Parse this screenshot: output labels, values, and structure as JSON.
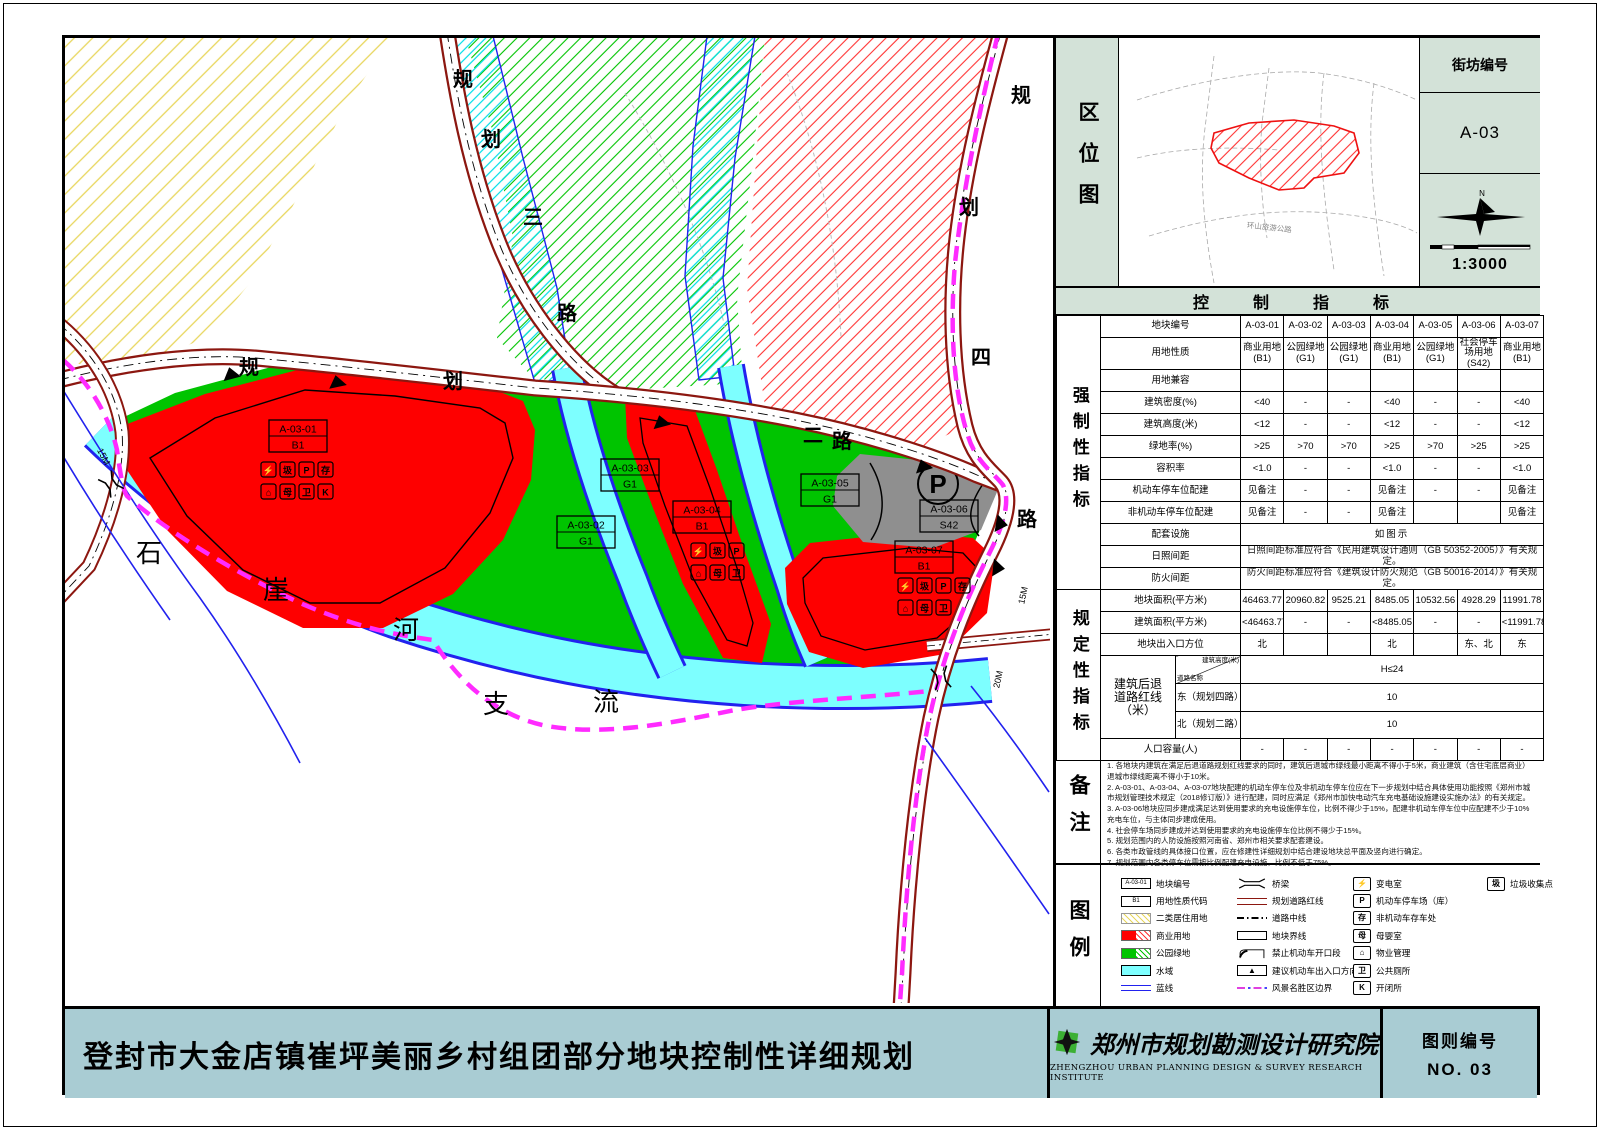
{
  "sheet": {
    "title": "登封市大金店镇崔坪美丽乡村组团部分地块控制性详细规划",
    "institute_name": "郑州市规划勘测设计研究院",
    "institute_name_en": "ZHENGZHOU URBAN PLANNING DESIGN & SURVEY RESEARCH INSTITUTE",
    "sheet_no_label": "图则编号",
    "sheet_no_value": "NO. 03"
  },
  "location_map": {
    "panel_title": "区位图",
    "block_label": "街坊编号",
    "block_value": "A-03",
    "scale_text": "1:3000",
    "north_label": "N",
    "road_label": "环山旅游公路"
  },
  "control_table": {
    "title": "控　制　指　标",
    "mandatory_label": "强制性指标",
    "prescriptive_label": "规定性指标",
    "plot_row_label": "地块编号",
    "plots": [
      "A-03-01",
      "A-03-02",
      "A-03-03",
      "A-03-04",
      "A-03-05",
      "A-03-06",
      "A-03-07"
    ],
    "rows": [
      {
        "label": "用地性质",
        "values": [
          "商业用地\n(B1)",
          "公园绿地\n(G1)",
          "公园绿地\n(G1)",
          "商业用地\n(B1)",
          "公园绿地\n(G1)",
          "社会停车\n场用地(S42)",
          "商业用地\n(B1)"
        ]
      },
      {
        "label": "用地兼容",
        "values": [
          "",
          "",
          "",
          "",
          "",
          "",
          ""
        ]
      },
      {
        "label": "建筑密度(%)",
        "values": [
          "<40",
          "-",
          "-",
          "<40",
          "-",
          "-",
          "<40"
        ]
      },
      {
        "label": "建筑高度(米)",
        "values": [
          "<12",
          "-",
          "-",
          "<12",
          "-",
          "-",
          "<12"
        ]
      },
      {
        "label": "绿地率(%)",
        "values": [
          ">25",
          ">70",
          ">70",
          ">25",
          ">70",
          ">25",
          ">25"
        ]
      },
      {
        "label": "容积率",
        "values": [
          "<1.0",
          "-",
          "-",
          "<1.0",
          "-",
          "-",
          "<1.0"
        ]
      },
      {
        "label": "机动车停车位配建",
        "values": [
          "见备注",
          "-",
          "-",
          "见备注",
          "-",
          "-",
          "见备注"
        ]
      },
      {
        "label": "非机动车停车位配建",
        "values": [
          "见备注",
          "-",
          "-",
          "见备注",
          "",
          "",
          "见备注"
        ]
      }
    ],
    "span_rows": [
      {
        "label": "配套设施",
        "value": "如图示",
        "big": true
      },
      {
        "label": "日照间距",
        "value": "日照间距标准应符合《民用建筑设计通则（GB 50352-2005）》有关规定。",
        "big": false
      },
      {
        "label": "防火间距",
        "value": "防火间距标准应符合《建筑设计防火规范（GB 50016-2014）》有关规定。",
        "big": false
      }
    ],
    "prescriptive_rows": [
      {
        "label": "地块面积(平方米)",
        "values": [
          "46463.77",
          "20960.82",
          "9525.21",
          "8485.05",
          "10532.56",
          "4928.29",
          "11991.78"
        ]
      },
      {
        "label": "建筑面积(平方米)",
        "values": [
          "<46463.77",
          "-",
          "-",
          "<8485.05",
          "-",
          "-",
          "<11991.78"
        ]
      },
      {
        "label": "地块出入口方位",
        "values": [
          "北",
          "",
          "",
          "北",
          "",
          "东、北",
          "东"
        ]
      }
    ],
    "setback": {
      "label": "建筑后退\n道路红线\n（米）",
      "diag_top": "建筑高度(米)",
      "diag_bottom": "道路名称",
      "height_value": "H≤24",
      "roads": [
        {
          "name": "东（规划四路）",
          "value": "10"
        },
        {
          "name": "北（规划二路）",
          "value": "10"
        }
      ]
    },
    "capacity_row": {
      "label": "人口容量(人)",
      "values": [
        "-",
        "-",
        "-",
        "-",
        "-",
        "-",
        "-"
      ]
    }
  },
  "notes": {
    "label": "备注",
    "lines": [
      "1. 各地块内建筑在满足后退道路规划红线要求的同时，建筑后退城市绿线最小距离不得小于5米，商业建筑（含住宅底层商业）退城市绿线距离不得小于10米。",
      "2. A-03-01、A-03-04、A-03-07地块配建的机动车停车位及非机动车停车位应在下一步规划中结合具体使用功能按照《郑州市城市规划管理技术规定（2018修订版）》进行配建，同时应满足《郑州市加快电动汽车充电基础设施建设实施办法》的有关规定。",
      "3. A-03-06地块应同步建成满足达到使用要求的充电设施停车位，比例不得少于15%，配建非机动车停车位中应配建不少于10%充电车位，与主体同步建成使用。",
      "4. 社会停车场同步建成并达到使用要求的充电设施停车位比例不得少于15%。",
      "5. 规划范围内的人防设施按照河南省、郑州市相关要求配套建设。",
      "6. 各类市政管线的具体接口位置，应在修建性详细规划中结合建设地块总平面及竖向进行确定。",
      "7. 规划范围内各类停车位需按比例配建充电设施，比例不低于75%。"
    ]
  },
  "legend": {
    "label": "图例",
    "col1": [
      {
        "type": "codebox",
        "text": "A-03-01",
        "label": "地块编号"
      },
      {
        "type": "codebox",
        "text": "B1",
        "label": "用地性质代码"
      },
      {
        "type": "hatchY",
        "label": "二类居住用地"
      },
      {
        "type": "red",
        "label": "商业用地"
      },
      {
        "type": "green",
        "label": "公园绿地"
      },
      {
        "type": "cyan",
        "label": "水域"
      },
      {
        "type": "blueline",
        "label": "蓝线"
      }
    ],
    "col2": [
      {
        "type": "bridge",
        "label": "桥梁"
      },
      {
        "type": "redline",
        "label": "规划道路红线"
      },
      {
        "type": "centerline",
        "label": "道路中线"
      },
      {
        "type": "plotline",
        "label": "地块界线"
      },
      {
        "type": "noopen",
        "label": "禁止机动车开口段"
      },
      {
        "type": "arrow",
        "label": "建议机动车出入口方向"
      },
      {
        "type": "scenic",
        "label": "风景名胜区边界"
      }
    ],
    "col3": [
      {
        "type": "glyph",
        "text": "⚡",
        "label": "变电室"
      },
      {
        "type": "glyph",
        "text": "P",
        "label": "机动车停车场（库）"
      },
      {
        "type": "glyph",
        "text": "存",
        "label": "非机动车存车处"
      },
      {
        "type": "glyph",
        "text": "母",
        "label": "母婴室"
      },
      {
        "type": "glyph",
        "text": "⌂",
        "label": "物业管理"
      },
      {
        "type": "glyph",
        "text": "卫",
        "label": "公共厕所"
      },
      {
        "type": "glyph",
        "text": "K",
        "label": "开闭所"
      }
    ],
    "col4": [
      {
        "type": "glyph",
        "text": "圾",
        "label": "垃圾收集点"
      }
    ]
  },
  "map": {
    "plots": [
      {
        "code": "A-03-01",
        "cls": "B1"
      },
      {
        "code": "A-03-02",
        "cls": "G1"
      },
      {
        "code": "A-03-03",
        "cls": "G1"
      },
      {
        "code": "A-03-04",
        "cls": "B1"
      },
      {
        "code": "A-03-05",
        "cls": "G1"
      },
      {
        "code": "A-03-06",
        "cls": "S42"
      },
      {
        "code": "A-03-07",
        "cls": "B1"
      }
    ],
    "road2_chars": [
      "规",
      "划",
      "二",
      "路"
    ],
    "road3_chars": [
      "规",
      "划",
      "三",
      "路"
    ],
    "road4_chars": [
      "规",
      "划",
      "四",
      "路"
    ],
    "river_chars": [
      "石",
      "崖",
      "河",
      "支",
      "流"
    ],
    "width_label_left": "15M",
    "width_label_right": "15M",
    "width_label_bottom": "20M",
    "parking_glyph": "P",
    "icon_rows": [
      [
        "⚡",
        "圾",
        "P",
        "存"
      ],
      [
        "⌂",
        "母",
        "卫",
        "K"
      ]
    ]
  }
}
